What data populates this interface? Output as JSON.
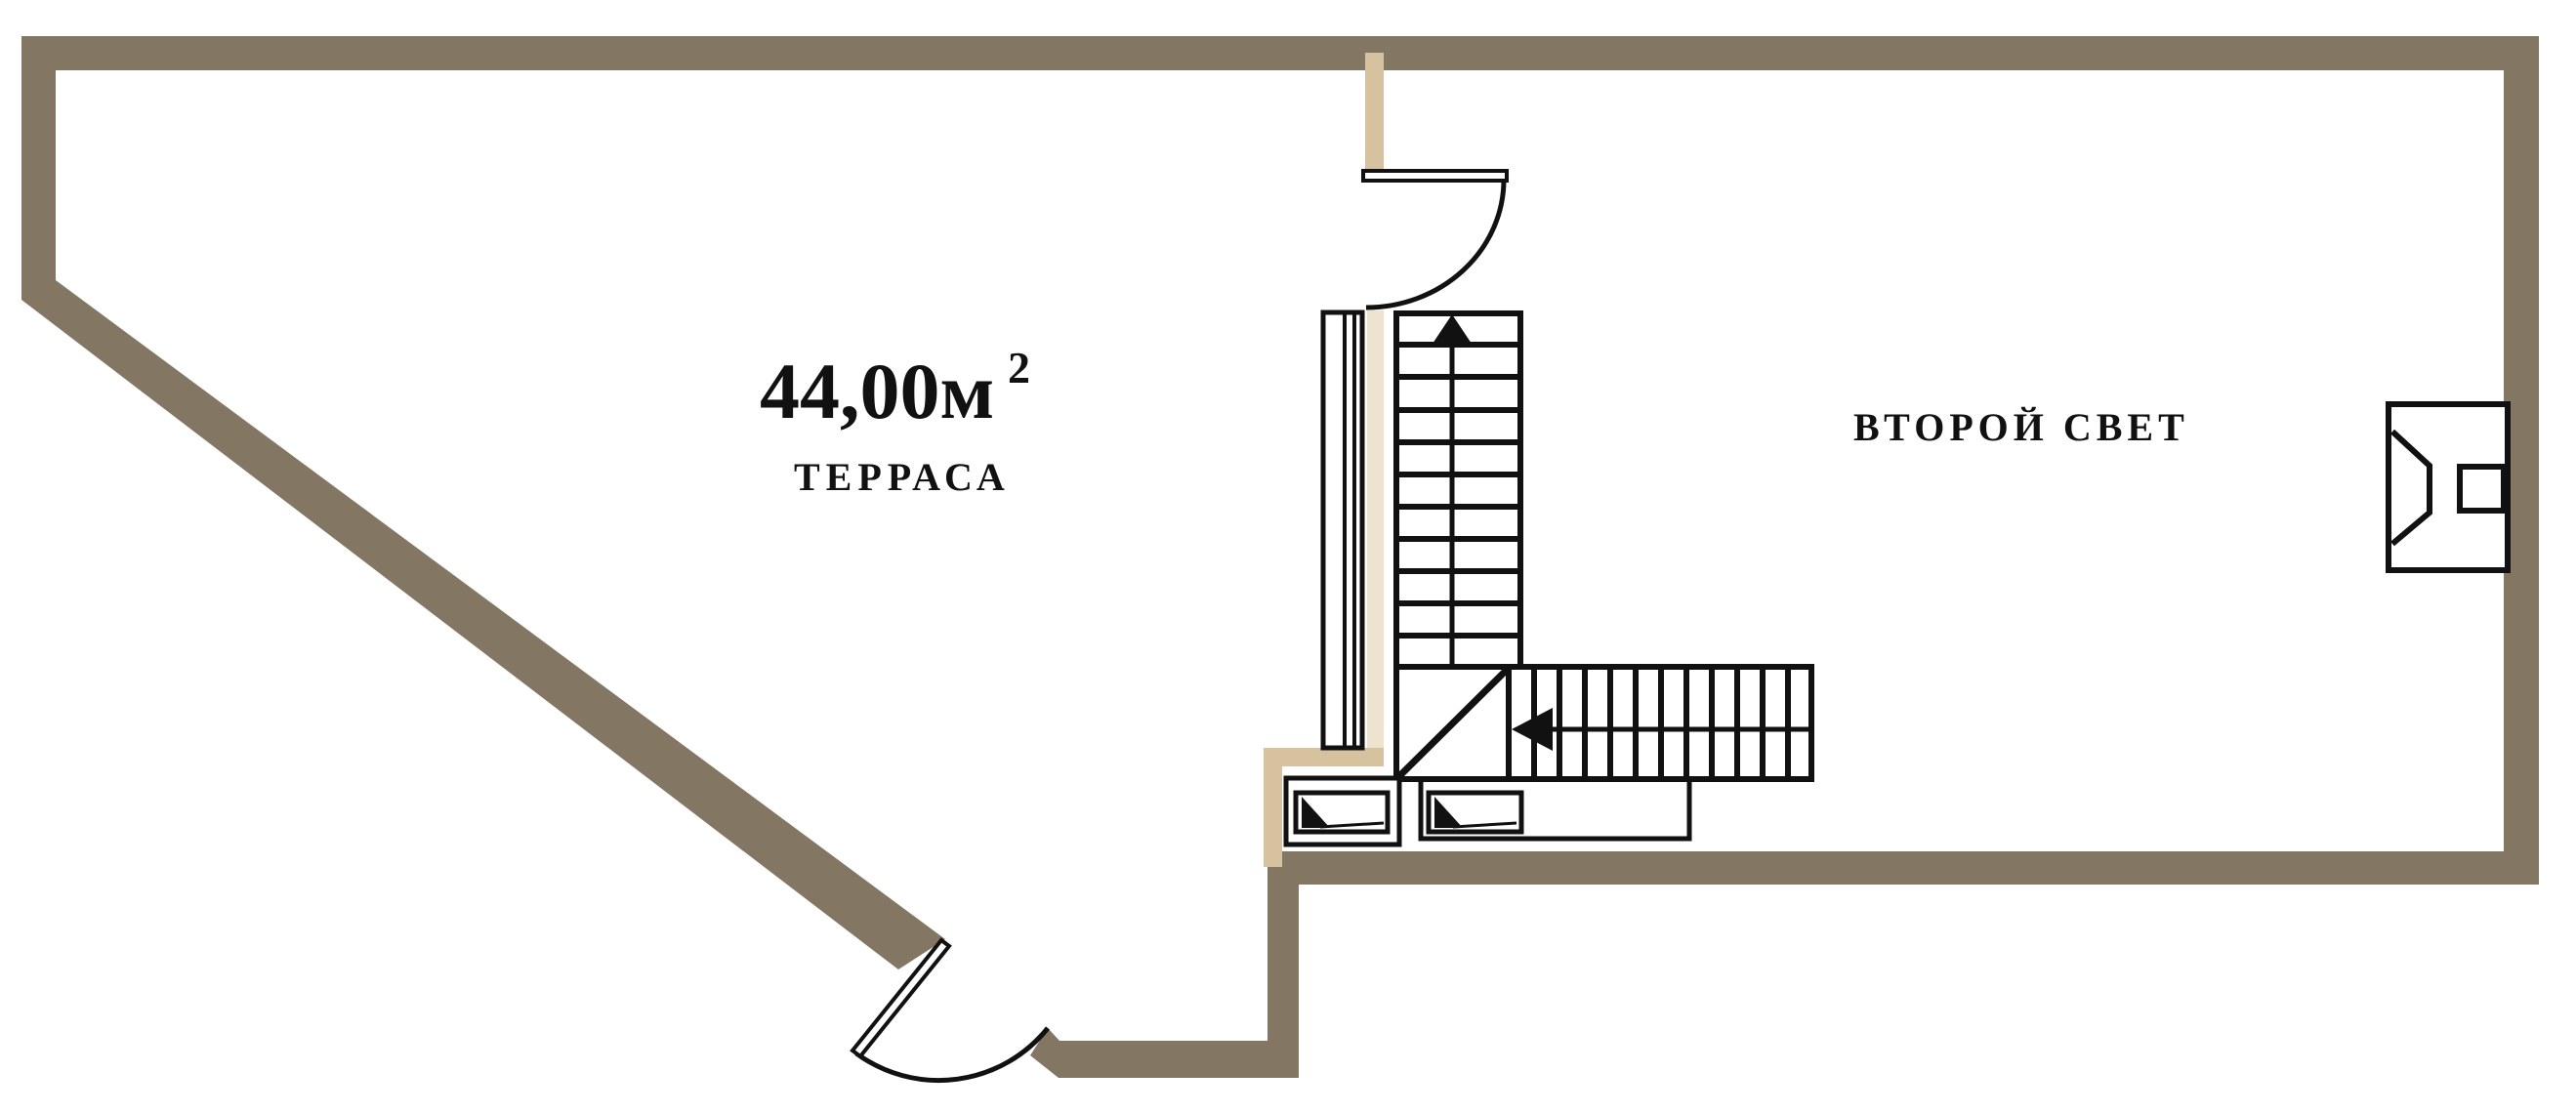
{
  "colors": {
    "wall": "#837663",
    "wall_tan": "#D6C29E",
    "wall_pale": "#EDE3CE",
    "line": "#111111",
    "background": "#FFFFFF"
  },
  "rooms": {
    "terrace": {
      "name": "ТЕРРАСА",
      "area_value": "44,00м",
      "area_sup": "2"
    },
    "second_light": {
      "name": "ВТОРОЙ СВЕТ"
    }
  }
}
